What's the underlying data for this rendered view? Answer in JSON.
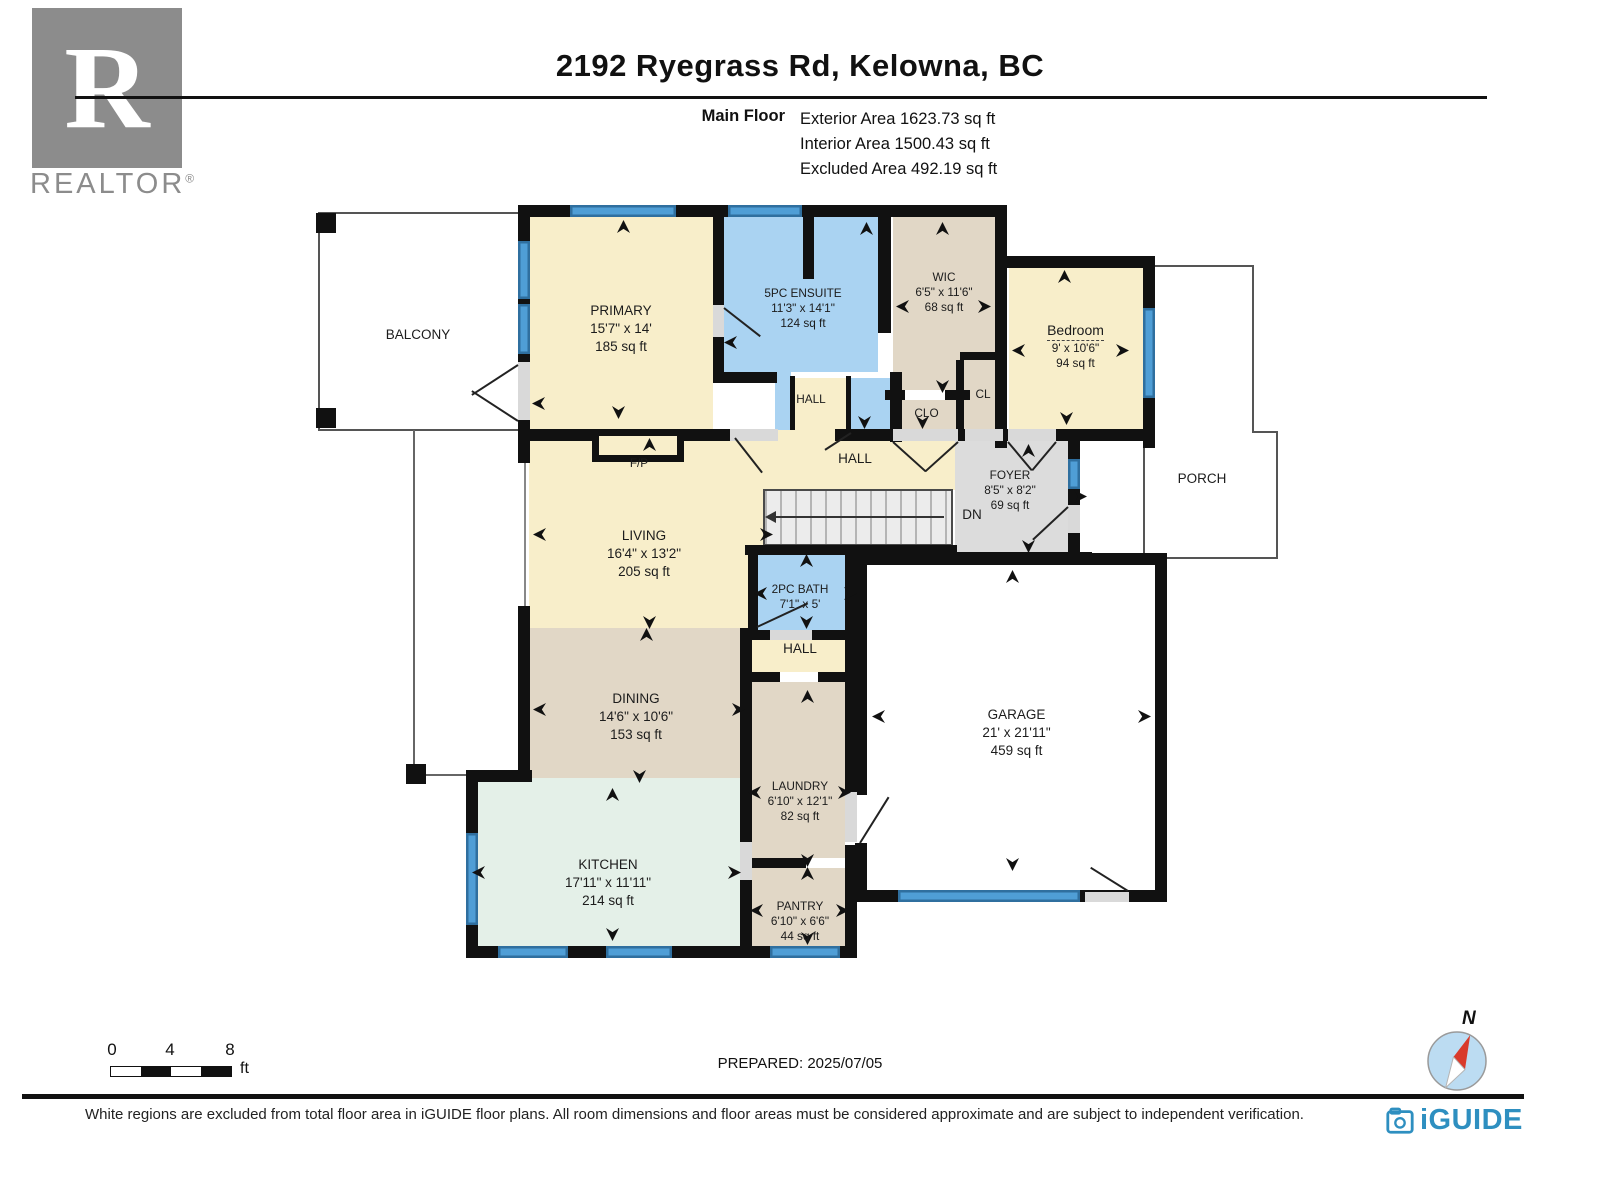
{
  "header": {
    "title": "2192 Ryegrass Rd, Kelowna, BC",
    "floor_label": "Main Floor",
    "area_lines": [
      "Exterior Area 1623.73 sq ft",
      "Interior Area 1500.43 sq ft",
      "Excluded Area 492.19 sq ft"
    ]
  },
  "branding": {
    "realtor_letter": "R",
    "realtor_text": "REALTOR",
    "realtor_reg": "®",
    "iguide_text": "iGUIDE"
  },
  "rooms": {
    "balcony": {
      "name": "BALCONY"
    },
    "primary": {
      "name": "PRIMARY",
      "dims": "15'7\" x 14'",
      "area": "185 sq ft"
    },
    "ensuite": {
      "name": "5PC ENSUITE",
      "dims": "11'3\" x 14'1\"",
      "area": "124 sq ft"
    },
    "wic": {
      "name": "WIC",
      "dims": "6'5\" x 11'6\"",
      "area": "68 sq ft"
    },
    "bedroom": {
      "name": "Bedroom",
      "dims": "9' x 10'6\"",
      "area": "94 sq ft"
    },
    "hall_upper": {
      "name": "HALL"
    },
    "clo": {
      "name": "CLO"
    },
    "cl": {
      "name": "CL"
    },
    "hall_main": {
      "name": "HALL"
    },
    "foyer": {
      "name": "FOYER",
      "dims": "8'5\" x 8'2\"",
      "area": "69 sq ft"
    },
    "porch": {
      "name": "PORCH"
    },
    "fireplace": {
      "name": "F/P"
    },
    "living": {
      "name": "LIVING",
      "dims": "16'4\" x 13'2\"",
      "area": "205 sq ft"
    },
    "stairs": {
      "name": "DN"
    },
    "bath": {
      "name": "2PC BATH",
      "dims": "7'1\" x 5'"
    },
    "hall_lower": {
      "name": "HALL"
    },
    "dining": {
      "name": "DINING",
      "dims": "14'6\" x 10'6\"",
      "area": "153 sq ft"
    },
    "garage": {
      "name": "GARAGE",
      "dims": "21' x 21'11\"",
      "area": "459 sq ft"
    },
    "kitchen": {
      "name": "KITCHEN",
      "dims": "17'11\" x 11'11\"",
      "area": "214 sq ft"
    },
    "laundry": {
      "name": "LAUNDRY",
      "dims": "6'10\" x 12'1\"",
      "area": "82 sq ft"
    },
    "pantry": {
      "name": "PANTRY",
      "dims": "6'10\" x 6'6\"",
      "area": "44 sq ft"
    }
  },
  "scale_bar": {
    "ticks": [
      "0",
      "4",
      "8"
    ],
    "unit": "ft"
  },
  "compass": {
    "label": "N"
  },
  "footer": {
    "prepared": "PREPARED: 2025/07/05",
    "disclaimer": "White regions are excluded from total floor area in iGUIDE floor plans. All room dimensions and floor areas must be considered approximate and are subject to independent verification."
  },
  "colors": {
    "room_cream": "#f8eeca",
    "room_blue": "#aad3f2",
    "room_tan": "#e1d7c6",
    "room_mint": "#e4f0e8",
    "room_gray": "#dcdcdc",
    "wall": "#111111",
    "window": "#4f9ed6",
    "niche": "#d9d9d9",
    "iguide_blue": "#2e8fc0",
    "realtor_gray": "#8c8c8c",
    "compass_red": "#d93a2b"
  }
}
